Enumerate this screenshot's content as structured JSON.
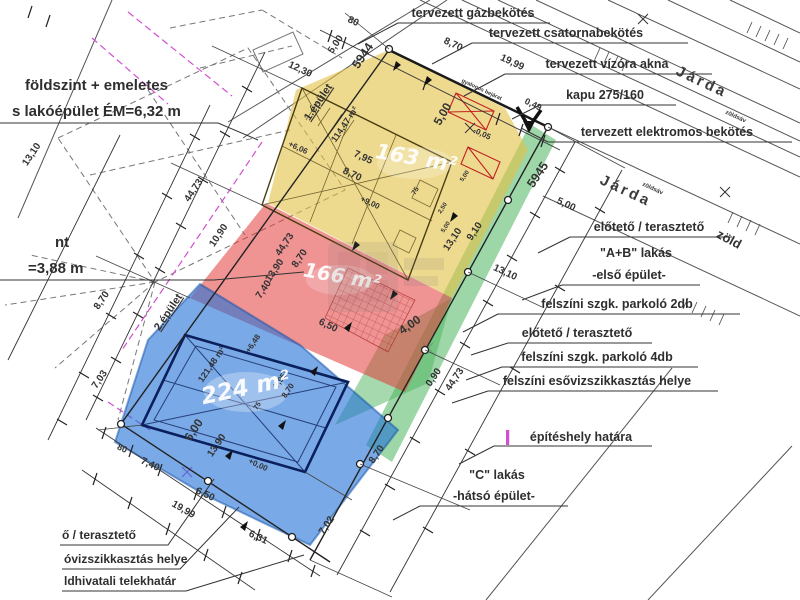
{
  "colors": {
    "yellow": "#e3c245",
    "red": "#e23b3b",
    "green": "#4db45e",
    "blue": "#1f6fd6",
    "magenta": "#cc3fcc",
    "dim_red": "#cc2222",
    "dim_blue": "#2338cc",
    "ink": "#333333"
  },
  "labels": {
    "gaz": "tervezett gázbekötés",
    "csat": "tervezett csatornabekötés",
    "viz": "tervezett vízóra akna",
    "kapu": "kapu 275/160",
    "elektromos": "tervezett elektromos bekötés",
    "eloteto_a": "előtető / terasztető",
    "ab": "\"A+B\" lakás",
    "elso": "-első épület-",
    "parkolo2": "felszíni szgk. parkoló 2db",
    "eloteto_b": "előtető / terasztető",
    "parkolo4": "felszíni szgk. parkoló 4db",
    "esoviz": "felszíni esővizszikkasztás helye",
    "epiteshely": "építéshely határa",
    "c_lakas": "\"C\" lakás",
    "hatso": "-hátsó épület-",
    "foldszint": "földszint + emeletes",
    "lakoepulet": "s lakóépület ÉM=6,32 m",
    "nt": "nt",
    "m388": "=3,88 m",
    "cut1": "ő / terasztető",
    "cut2": "óvizszikkasztás helye",
    "cut3": "ldhivatali telekhatár",
    "ep1": "1.épület",
    "ep2": "2.épület",
    "jarda": "Járda",
    "zoldsav": "zöldsáv",
    "zold": "zöld",
    "gyalogos": "gyalogos bejárat",
    "p5944": "5944",
    "p5945": "5945"
  },
  "areas": {
    "a163": "163 m²",
    "a166": "166 m²",
    "a224": "224 m²"
  },
  "dims": [
    {
      "t": "80",
      "x": 352,
      "y": 24,
      "r": 25,
      "s": 10
    },
    {
      "t": "8,70",
      "x": 452,
      "y": 47,
      "r": 25,
      "s": 10
    },
    {
      "t": "19,99",
      "x": 511,
      "y": 65,
      "r": 25,
      "s": 10
    },
    {
      "t": "0,49",
      "x": 532,
      "y": 107,
      "r": 25,
      "s": 9
    },
    {
      "t": "12,30",
      "x": 299,
      "y": 72,
      "r": 25,
      "s": 10
    },
    {
      "t": "5,00",
      "x": 338,
      "y": 46,
      "r": -56,
      "s": 10
    },
    {
      "t": "44,73",
      "x": 196,
      "y": 192,
      "r": -56,
      "s": 10
    },
    {
      "t": "10,90",
      "x": 221,
      "y": 237,
      "r": -56,
      "s": 10
    },
    {
      "t": "8,70",
      "x": 104,
      "y": 302,
      "r": -56,
      "s": 10
    },
    {
      "t": "7,03",
      "x": 102,
      "y": 381,
      "r": -56,
      "s": 10
    },
    {
      "t": "13,10",
      "x": 34,
      "y": 156,
      "r": -56,
      "s": 10
    },
    {
      "t": "44,73",
      "x": 287,
      "y": 246,
      "r": -56,
      "s": 10
    },
    {
      "t": "8,70",
      "x": 302,
      "y": 260,
      "r": -56,
      "s": 10
    },
    {
      "t": "13,90",
      "x": 277,
      "y": 272,
      "r": -56,
      "s": 10
    },
    {
      "t": "7,40",
      "x": 266,
      "y": 291,
      "r": -56,
      "s": 10
    },
    {
      "t": "6,50",
      "x": 327,
      "y": 328,
      "r": 25,
      "s": 10
    },
    {
      "t": "7,95",
      "x": 362,
      "y": 160,
      "r": 25,
      "s": 10
    },
    {
      "t": "8,70",
      "x": 351,
      "y": 177,
      "r": 25,
      "s": 10
    },
    {
      "t": "+9,00",
      "x": 369,
      "y": 205,
      "r": 25,
      "s": 8
    },
    {
      "t": "-0,05",
      "x": 481,
      "y": 136,
      "r": 25,
      "s": 8
    },
    {
      "t": "75",
      "x": 417,
      "y": 192,
      "r": -56,
      "s": 7
    },
    {
      "t": "5,00",
      "x": 466,
      "y": 177,
      "r": -56,
      "s": 6
    },
    {
      "t": "2,50",
      "x": 444,
      "y": 209,
      "r": -56,
      "s": 6
    },
    {
      "t": "5,00",
      "x": 447,
      "y": 228,
      "r": -56,
      "s": 6
    },
    {
      "t": "5,00",
      "x": 565,
      "y": 207,
      "r": 25,
      "s": 10
    },
    {
      "t": "13,10",
      "x": 504,
      "y": 275,
      "r": 25,
      "s": 10
    },
    {
      "t": "9,10",
      "x": 477,
      "y": 233,
      "r": -56,
      "s": 10
    },
    {
      "t": "13,10",
      "x": 455,
      "y": 241,
      "r": -56,
      "s": 10
    },
    {
      "t": "0,90",
      "x": 436,
      "y": 379,
      "r": -56,
      "s": 10
    },
    {
      "t": "44,73",
      "x": 457,
      "y": 381,
      "r": -56,
      "s": 10
    },
    {
      "t": "8,70",
      "x": 379,
      "y": 456,
      "r": -56,
      "s": 10
    },
    {
      "t": "7,02",
      "x": 329,
      "y": 527,
      "r": -56,
      "s": 10
    },
    {
      "t": "5,00",
      "x": 446,
      "y": 116,
      "r": -60,
      "s": 12,
      "c": "dim_red"
    },
    {
      "t": "6,00",
      "x": 197,
      "y": 432,
      "r": -56,
      "s": 12,
      "c": "dim_blue"
    },
    {
      "t": "4,00",
      "x": 412,
      "y": 328,
      "r": -35,
      "s": 12,
      "c": "magenta"
    },
    {
      "t": "80",
      "x": 121,
      "y": 451,
      "r": 25,
      "s": 9
    },
    {
      "t": "7,40",
      "x": 149,
      "y": 467,
      "r": 25,
      "s": 10
    },
    {
      "t": "19,99",
      "x": 182,
      "y": 512,
      "r": 30,
      "s": 10
    },
    {
      "t": "6,50",
      "x": 204,
      "y": 497,
      "r": 25,
      "s": 10
    },
    {
      "t": "6,31",
      "x": 257,
      "y": 540,
      "r": 25,
      "s": 10
    },
    {
      "t": "13,90",
      "x": 219,
      "y": 447,
      "r": -56,
      "s": 10
    },
    {
      "t": "+0,00",
      "x": 257,
      "y": 467,
      "r": 25,
      "s": 8
    },
    {
      "t": "+6,48",
      "x": 255,
      "y": 345,
      "r": -56,
      "s": 8
    },
    {
      "t": "121,48 m²",
      "x": 214,
      "y": 366,
      "r": -56,
      "s": 9
    },
    {
      "t": "75",
      "x": 259,
      "y": 407,
      "r": -56,
      "s": 7
    },
    {
      "t": "7,95",
      "x": 282,
      "y": 382,
      "r": -56,
      "s": 8
    },
    {
      "t": "8,70",
      "x": 290,
      "y": 392,
      "r": -56,
      "s": 8
    },
    {
      "t": "114,47 m²",
      "x": 347,
      "y": 126,
      "r": -56,
      "s": 9
    },
    {
      "t": "+6,06",
      "x": 297,
      "y": 150,
      "r": 25,
      "s": 8
    }
  ]
}
